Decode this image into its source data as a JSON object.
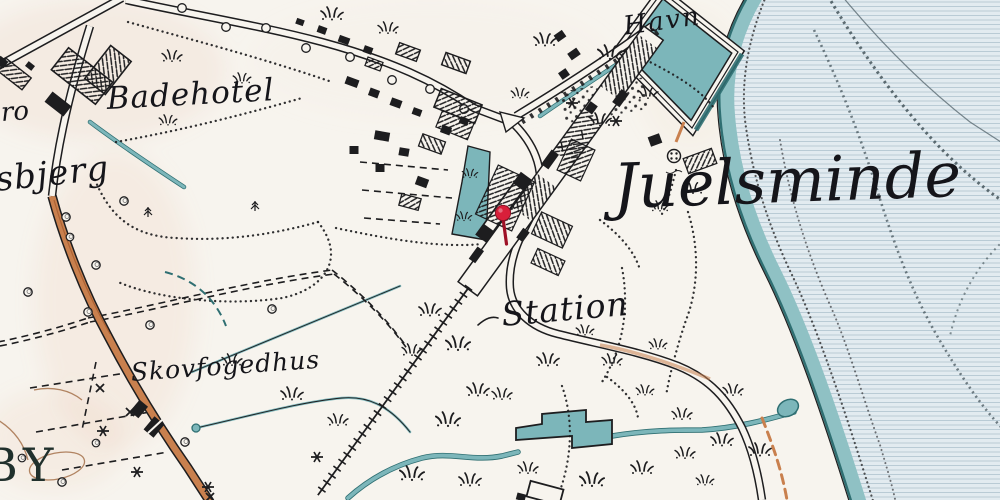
{
  "map": {
    "labels": {
      "city": "Juelsminde",
      "harbor": "Havn",
      "bath_hotel": "Badehotel",
      "hill_partial": "sbjerg",
      "road_partial": "ro",
      "station": "Station",
      "forester_house": "Skovfogedhus",
      "village_partial": "BY"
    },
    "marker": {
      "type": "map-pin",
      "color": "#d81f3a"
    },
    "colors": {
      "paper": "#f7f4ee",
      "ink": "#1d1d1f",
      "sea": "#e2ebf0",
      "seaLine": "#b4c8d3",
      "shore": "#8fc1c4",
      "shoreDark": "#2f6f72",
      "stream": "#7cb6ba",
      "orange": "#c9804e",
      "orangeDark": "#a65b2e",
      "brown": "#a5714b",
      "pin": "#d81f3a",
      "pinDark": "#9e1126"
    }
  }
}
